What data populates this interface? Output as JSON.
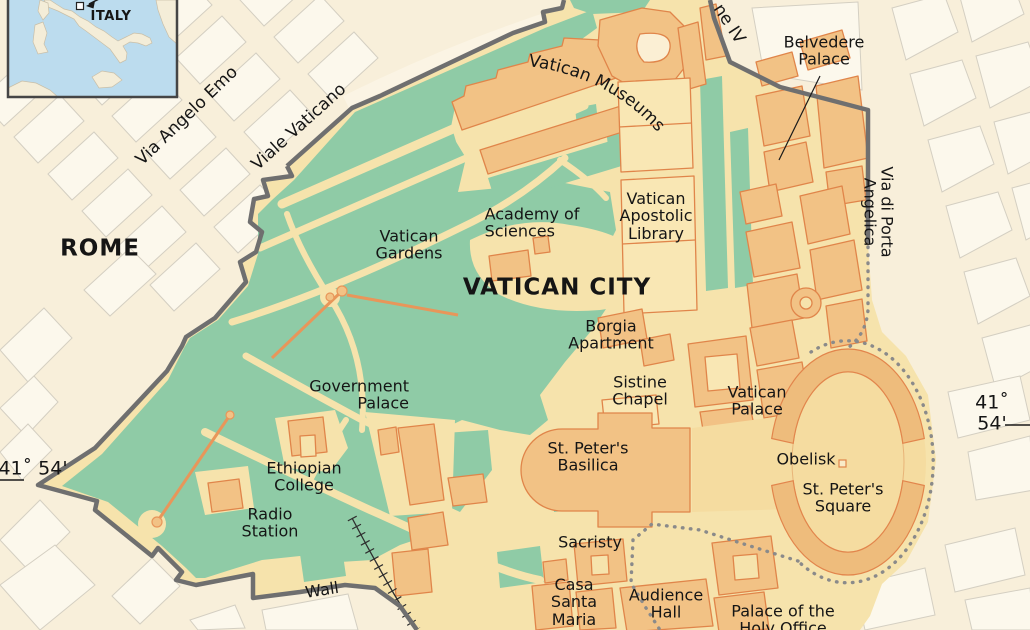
{
  "map": {
    "title": "VATICAN CITY",
    "city": "ROME",
    "inset_country": "ITALY",
    "latitude": {
      "left": "41˚ 54'",
      "right": "41˚ 54'"
    },
    "streets": {
      "via_angelo_emo": "Via Angelo Emo",
      "viale_vaticano": "Viale Vaticano",
      "leone_iv": "ne IV",
      "via_di_porta_angelica": "Via di Porta Angelica",
      "wall": "Wall"
    },
    "places": {
      "vatican_museums": "Vatican Museums",
      "belvedere_palace": "Belvedere\nPalace",
      "vatican_apostolic_library": "Vatican\nApostolic\nLibrary",
      "academy_of_sciences": "Academy of\nSciences",
      "vatican_gardens": "Vatican\nGardens",
      "borgia_apartment": "Borgia\nApartment",
      "sistine_chapel": "Sistine\nChapel",
      "vatican_palace": "Vatican\nPalace",
      "government_palace": "Government\nPalace",
      "st_peters_basilica": "St. Peter's\nBasilica",
      "ethiopian_college": "Ethiopian\nCollege",
      "radio_station": "Radio\nStation",
      "obelisk": "Obelisk",
      "st_peters_square": "St. Peter's\nSquare",
      "sacristy": "Sacristy",
      "casa_santa_maria": "Casa\nSanta\nMaria",
      "audience_hall": "Audience\nHall",
      "palace_of_the_holy_office": "Palace of the\nHoly Office"
    },
    "palette": {
      "outside_background": "#F8EFDA",
      "city_block": "#FCF8EC",
      "vatican_ground": "#F6E3AC",
      "garden_green": "#8FCBA6",
      "building_fill": "#F2C285",
      "building_stroke": "#E0854A",
      "building_light": "#F9E7B4",
      "square_fill": "#F5DCA0",
      "colonnade_fill": "#EEBC7C",
      "wall_gray": "#6F6F6F",
      "dotted_border": "#8A8A8A",
      "inset_sea": "#BCDCEE",
      "inset_land": "#F4EDD8"
    }
  }
}
